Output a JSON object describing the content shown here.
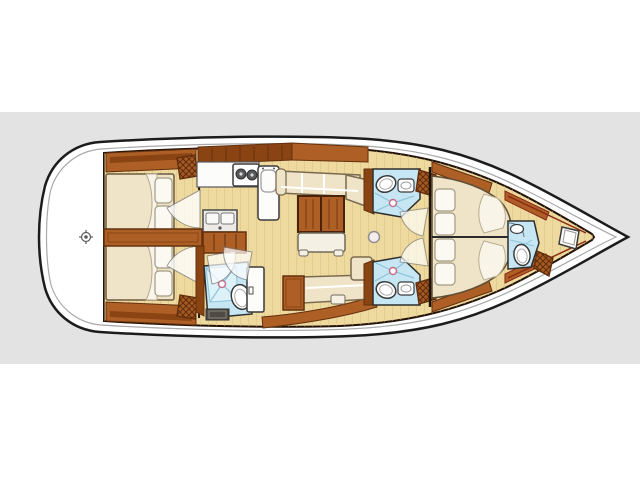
{
  "page": {
    "background": "#ffffff",
    "band_color": "#e3e3e4"
  },
  "palette": {
    "hull_fill": "#ffffff",
    "hull_outline": "#1c1c1c",
    "deck_line": "#a9a9a9",
    "floor": "#eeda9f",
    "plank": "#d8ba7c",
    "wood": "#ad5f26",
    "wood_dark": "#63300e",
    "wood_deep": "#8a4414",
    "cushion": "#efe4c7",
    "cushion_edge": "#7a6a4f",
    "bed_white": "#f8f4e8",
    "pillow": "#fbf9f1",
    "pillow_edge": "#a39a82",
    "fixture": "#fcfcfa",
    "fixture_stroke": "#3a3a3a",
    "bath": "#c6e6f3",
    "bath_pan": "#ddf1f8",
    "bath_line": "#8fc4da",
    "shower_dot": "#c96e8a",
    "hatch": "#a55a22",
    "hatch_line": "#5f2c0c",
    "mat": "#4f4a43",
    "trim_red": "#8c2b16",
    "mast": "#f5ecee",
    "burner": "#58595b",
    "sink_steel": "#eceae6"
  },
  "vessel": {
    "orientation": "bow-right",
    "regions": {
      "transom_deck": {
        "fixtures": [
          "helm-position-marker"
        ]
      },
      "aft_cabin_top": {
        "fixtures": [
          "double-berth",
          "pillow",
          "pillow",
          "blanket-fold",
          "hull-shelf",
          "hatch-locker",
          "door-swing"
        ]
      },
      "aft_cabin_bottom": {
        "fixtures": [
          "double-berth",
          "pillow",
          "pillow",
          "blanket-fold",
          "hull-shelf",
          "hatch-locker",
          "door-swing"
        ]
      },
      "galley": {
        "fixtures": [
          "overhead-lockers",
          "counter",
          "two-burner-stove",
          "top-loading-fridge",
          "double-sink",
          "under-sink-cabinet"
        ]
      },
      "salon": {
        "fixtures": [
          "l-sofa",
          "dining-table-two-leaf",
          "white-bench",
          "side-bench",
          "storage-cabinet",
          "stool-seat",
          "mast-post"
        ]
      },
      "aft_head": {
        "fixtures": [
          "shower-pan",
          "toilet",
          "vanity-sink",
          "floor-grate",
          "door-swing",
          "door-swing"
        ]
      },
      "mid_head_top": {
        "fixtures": [
          "toilet",
          "sink",
          "shower-floor",
          "hatch-locker",
          "door-swing"
        ]
      },
      "mid_head_bottom": {
        "fixtures": [
          "toilet",
          "sink",
          "shower-floor",
          "hatch-locker",
          "door-swing"
        ]
      },
      "forward_cabin": {
        "fixtures": [
          "island-double-berth",
          "pillow",
          "pillow",
          "pillow",
          "pillow",
          "blanket-scallop",
          "hull-trim",
          "centerline"
        ]
      },
      "forward_head": {
        "fixtures": [
          "toilet",
          "sink",
          "door-swing"
        ]
      },
      "bow_area": {
        "fixtures": [
          "hatch-locker",
          "seat-locker"
        ]
      }
    }
  }
}
